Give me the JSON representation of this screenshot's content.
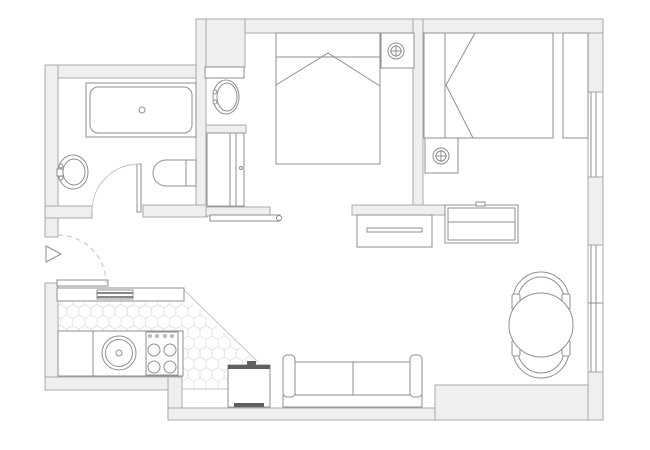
{
  "plan": {
    "canvas": {
      "w": 650,
      "h": 450,
      "bg": "#ffffff"
    },
    "palette": {
      "wallFill": "#efefef",
      "wallStroke": "#a9a9a9",
      "line": "#8f8f8f",
      "lightLine": "#c6c6c6",
      "dashLine": "#c2c2c2",
      "dark": "#606060",
      "hexLine": "#e6e6e6",
      "white": "#ffffff"
    },
    "elements": [
      {
        "name": "kitchen-hex-floor",
        "t": "polygon",
        "pts": "58,300 184,296 256,362 229,389 183,389 183,331 58,331",
        "f": "hex",
        "s": "none"
      },
      {
        "name": "top-wall",
        "t": "rect",
        "x": 197,
        "y": 19,
        "w": 406,
        "h": 14,
        "f": "wallFill",
        "s": "wallStroke"
      },
      {
        "name": "niche-top-wall-block",
        "t": "rect",
        "x": 196,
        "y": 19,
        "w": 49,
        "h": 48,
        "f": "wallFill",
        "s": "wallStroke"
      },
      {
        "name": "bathroom-top-wall",
        "t": "rect",
        "x": 45,
        "y": 65,
        "w": 152,
        "h": 13,
        "f": "wallFill",
        "s": "wallStroke"
      },
      {
        "name": "left-wall-upper",
        "t": "rect",
        "x": 45,
        "y": 65,
        "w": 13,
        "h": 172,
        "f": "wallFill",
        "s": "wallStroke"
      },
      {
        "name": "entry-wall-stub",
        "t": "rect",
        "x": 45,
        "y": 206,
        "w": 47,
        "h": 12,
        "f": "wallFill",
        "s": "wallStroke"
      },
      {
        "name": "left-wall-lower",
        "t": "rect",
        "x": 45,
        "y": 283,
        "w": 13,
        "h": 107,
        "f": "wallFill",
        "s": "wallStroke"
      },
      {
        "name": "bathroom-niche-wall",
        "t": "rect",
        "x": 196,
        "y": 19,
        "w": 10,
        "h": 198,
        "f": "wallFill",
        "s": "wallStroke"
      },
      {
        "name": "wc-bottom-wall",
        "t": "rect",
        "x": 143,
        "y": 205,
        "w": 64,
        "h": 12,
        "f": "wallFill",
        "s": "wallStroke"
      },
      {
        "name": "niche-bottom-bar",
        "t": "rect",
        "x": 206,
        "y": 207,
        "w": 64,
        "h": 9,
        "f": "wallFill",
        "s": "wallStroke"
      },
      {
        "name": "bedroom-divider-wall",
        "t": "rect",
        "x": 413,
        "y": 19,
        "w": 10,
        "h": 196,
        "f": "wallFill",
        "s": "wallStroke"
      },
      {
        "name": "bedroom-living-wall",
        "t": "rect",
        "x": 352,
        "y": 205,
        "w": 93,
        "h": 10,
        "f": "wallFill",
        "s": "wallStroke"
      },
      {
        "name": "kitchen-bottom-wall",
        "t": "rect",
        "x": 45,
        "y": 377,
        "w": 137,
        "h": 13,
        "f": "wallFill",
        "s": "wallStroke"
      },
      {
        "name": "bottom-jog-wall",
        "t": "rect",
        "x": 168,
        "y": 377,
        "w": 14,
        "h": 43,
        "f": "wallFill",
        "s": "wallStroke"
      },
      {
        "name": "bottom-wall-mid",
        "t": "rect",
        "x": 168,
        "y": 408,
        "w": 270,
        "h": 12,
        "f": "wallFill",
        "s": "wallStroke"
      },
      {
        "name": "bottom-wall-right",
        "t": "rect",
        "x": 435,
        "y": 385,
        "w": 168,
        "h": 35,
        "f": "wallFill",
        "s": "wallStroke"
      },
      {
        "name": "right-wall-upper",
        "t": "rect",
        "x": 588,
        "y": 33,
        "w": 15,
        "h": 59,
        "f": "wallFill",
        "s": "wallStroke"
      },
      {
        "name": "right-wall-mid",
        "t": "rect",
        "x": 588,
        "y": 177,
        "w": 15,
        "h": 68,
        "f": "wallFill",
        "s": "wallStroke"
      },
      {
        "name": "right-wall-lower",
        "t": "rect",
        "x": 588,
        "y": 372,
        "w": 15,
        "h": 48,
        "f": "wallFill",
        "s": "wallStroke"
      },
      {
        "name": "bedroom-window-opening",
        "t": "rect",
        "x": 588,
        "y": 92,
        "w": 15,
        "h": 85,
        "f": "white",
        "s": "wallStroke"
      },
      {
        "name": "bedroom-window-glass-a",
        "t": "line",
        "x1": 591,
        "y1": 92,
        "x2": 591,
        "y2": 177
      },
      {
        "name": "bedroom-window-glass-b",
        "t": "line",
        "x1": 596,
        "y1": 92,
        "x2": 596,
        "y2": 177
      },
      {
        "name": "living-window-opening",
        "t": "rect",
        "x": 588,
        "y": 245,
        "w": 15,
        "h": 127,
        "f": "white",
        "s": "wallStroke"
      },
      {
        "name": "living-window-glass-a",
        "t": "line",
        "x1": 591,
        "y1": 245,
        "x2": 591,
        "y2": 372
      },
      {
        "name": "living-window-glass-b",
        "t": "line",
        "x1": 596,
        "y1": 245,
        "x2": 596,
        "y2": 372
      },
      {
        "name": "living-window-mullion",
        "t": "line",
        "x1": 588,
        "y1": 303,
        "x2": 603,
        "y2": 303
      },
      {
        "name": "tile-edge-diagonal",
        "t": "line",
        "x1": 184,
        "y1": 290,
        "x2": 258,
        "y2": 362,
        "s": "lightLine"
      },
      {
        "name": "floor-step-line",
        "t": "line",
        "x1": 182,
        "y1": 389,
        "x2": 228,
        "y2": 389,
        "s": "lightLine"
      },
      {
        "name": "bathtub-outer",
        "t": "rect",
        "x": 86,
        "y": 83,
        "w": 110,
        "h": 54,
        "f": "white"
      },
      {
        "name": "bathtub-inner",
        "t": "rect",
        "x": 90,
        "y": 87,
        "w": 102,
        "h": 46,
        "rx": 8
      },
      {
        "name": "bathtub-drain",
        "t": "circle",
        "cx": 142,
        "cy": 110,
        "r": 3
      },
      {
        "name": "bathroom-sink",
        "t": "ellipse",
        "cx": 73,
        "cy": 172,
        "rx": 15,
        "ry": 17,
        "f": "white"
      },
      {
        "name": "bathroom-sink-basin",
        "t": "ellipse",
        "cx": 74,
        "cy": 172,
        "rx": 11,
        "ry": 13
      },
      {
        "name": "bathroom-sink-tap-a",
        "t": "circle",
        "cx": 61,
        "cy": 166,
        "r": 2,
        "f": "white"
      },
      {
        "name": "bathroom-sink-tap-b",
        "t": "circle",
        "cx": 61,
        "cy": 178,
        "r": 2,
        "f": "white"
      },
      {
        "name": "bathroom-sink-spout",
        "t": "rect",
        "x": 57,
        "y": 169,
        "w": 6,
        "h": 7,
        "f": "white"
      },
      {
        "name": "toilet",
        "t": "path",
        "d": "M196,160 L166,160 A13,13 0 0 0 166,186 L196,186 Z",
        "f": "white"
      },
      {
        "name": "toilet-tank-line",
        "t": "line",
        "x1": 186,
        "y1": 160,
        "x2": 186,
        "y2": 186
      },
      {
        "name": "vanity-top-bar",
        "t": "rect",
        "x": 205,
        "y": 67,
        "w": 39,
        "h": 11,
        "f": "white"
      },
      {
        "name": "niche-sink",
        "t": "ellipse",
        "cx": 226,
        "cy": 97,
        "rx": 13,
        "ry": 17,
        "f": "white"
      },
      {
        "name": "niche-sink-basin",
        "t": "ellipse",
        "cx": 227,
        "cy": 97,
        "rx": 10,
        "ry": 14
      },
      {
        "name": "niche-sink-tap-a",
        "t": "circle",
        "cx": 215,
        "cy": 92,
        "r": 2,
        "f": "white"
      },
      {
        "name": "niche-sink-tap-b",
        "t": "circle",
        "cx": 215,
        "cy": 102,
        "r": 2,
        "f": "white"
      },
      {
        "name": "niche-separator",
        "t": "rect",
        "x": 206,
        "y": 125,
        "w": 40,
        "h": 8,
        "f": "wallFill",
        "s": "wallStroke"
      },
      {
        "name": "niche-closet",
        "t": "rect",
        "x": 207,
        "y": 133,
        "w": 37,
        "h": 73,
        "f": "white"
      },
      {
        "name": "niche-closet-door-a",
        "t": "line",
        "x1": 230,
        "y1": 133,
        "x2": 230,
        "y2": 206
      },
      {
        "name": "niche-closet-door-b",
        "t": "line",
        "x1": 236,
        "y1": 133,
        "x2": 236,
        "y2": 206
      },
      {
        "name": "niche-closet-handle",
        "t": "circle",
        "cx": 241,
        "cy": 168,
        "r": 1.5
      },
      {
        "name": "bedroom-wall-shelf",
        "t": "rect",
        "x": 210,
        "y": 215,
        "w": 70,
        "h": 6,
        "f": "white"
      },
      {
        "name": "bedroom-shelf-knob",
        "t": "circle",
        "cx": 279,
        "cy": 218,
        "r": 2.5,
        "f": "white"
      },
      {
        "name": "bathroom-door-leaf",
        "t": "rect",
        "x": 137,
        "y": 164,
        "w": 4,
        "h": 48,
        "f": "white"
      },
      {
        "name": "bathroom-door-arc",
        "t": "path",
        "d": "M139,164 A47,47 0 0 0 92,211",
        "s": "lightLine"
      },
      {
        "name": "entry-door-leaf",
        "t": "rect",
        "x": 57,
        "y": 280,
        "w": 51,
        "h": 6,
        "f": "white"
      },
      {
        "name": "entry-door-arc",
        "t": "path",
        "d": "M58,235 A48,48 0 0 1 106,283",
        "s": "dashLine",
        "dash": "5,4"
      },
      {
        "name": "entry-arrow",
        "t": "polygon",
        "pts": "46,246 61,254 46,262",
        "f": "white"
      },
      {
        "name": "double-bed",
        "t": "rect",
        "x": 276,
        "y": 33,
        "w": 104,
        "h": 131,
        "f": "white"
      },
      {
        "name": "double-bed-blanket-line",
        "t": "line",
        "x1": 276,
        "y1": 57,
        "x2": 380,
        "y2": 57
      },
      {
        "name": "double-bed-fold",
        "t": "polyline",
        "pts": "276,85 328,53 380,86"
      },
      {
        "name": "nightstand-1",
        "t": "rect",
        "x": 381,
        "y": 33,
        "w": 33,
        "h": 35,
        "f": "white"
      },
      {
        "name": "lamp-1-outer",
        "t": "circle",
        "cx": 396,
        "cy": 51,
        "r": 8,
        "f": "white"
      },
      {
        "name": "lamp-1-inner",
        "t": "circle",
        "cx": 396,
        "cy": 51,
        "r": 5
      },
      {
        "name": "lamp-1-cross-v",
        "t": "line",
        "x1": 396,
        "y1": 45,
        "x2": 396,
        "y2": 57
      },
      {
        "name": "lamp-1-cross-h",
        "t": "line",
        "x1": 390,
        "y1": 51,
        "x2": 402,
        "y2": 51
      },
      {
        "name": "dresser-1",
        "t": "rect",
        "x": 357,
        "y": 215,
        "w": 75,
        "h": 32,
        "f": "white"
      },
      {
        "name": "dresser-1-handle",
        "t": "rect",
        "x": 367,
        "y": 228,
        "w": 55,
        "h": 4,
        "f": "white"
      },
      {
        "name": "single-bed",
        "t": "rect",
        "x": 424,
        "y": 33,
        "w": 129,
        "h": 105,
        "f": "white"
      },
      {
        "name": "single-bed-pillow-line",
        "t": "line",
        "x1": 445,
        "y1": 33,
        "x2": 445,
        "y2": 138
      },
      {
        "name": "single-bed-fold",
        "t": "polyline",
        "pts": "475,33 446,85 473,138"
      },
      {
        "name": "single-bed-headboard",
        "t": "rect",
        "x": 563,
        "y": 33,
        "w": 25,
        "h": 105,
        "f": "white"
      },
      {
        "name": "nightstand-2",
        "t": "rect",
        "x": 425,
        "y": 138,
        "w": 33,
        "h": 35,
        "f": "white"
      },
      {
        "name": "lamp-2-outer",
        "t": "circle",
        "cx": 441,
        "cy": 156,
        "r": 8,
        "f": "white"
      },
      {
        "name": "lamp-2-inner",
        "t": "circle",
        "cx": 441,
        "cy": 156,
        "r": 5
      },
      {
        "name": "lamp-2-cross-v",
        "t": "line",
        "x1": 441,
        "y1": 150,
        "x2": 441,
        "y2": 162
      },
      {
        "name": "lamp-2-cross-h",
        "t": "line",
        "x1": 435,
        "y1": 156,
        "x2": 447,
        "y2": 156
      },
      {
        "name": "dresser-2",
        "t": "rect",
        "x": 445,
        "y": 205,
        "w": 73,
        "h": 38,
        "f": "white"
      },
      {
        "name": "dresser-2-inner",
        "t": "rect",
        "x": 448,
        "y": 208,
        "w": 67,
        "h": 32
      },
      {
        "name": "dresser-2-line",
        "t": "line",
        "x1": 448,
        "y1": 222,
        "x2": 515,
        "y2": 222
      },
      {
        "name": "dresser-2-tab",
        "t": "rect",
        "x": 476,
        "y": 202,
        "w": 9,
        "h": 4,
        "f": "white"
      },
      {
        "name": "bar-counter",
        "t": "rect",
        "x": 57,
        "y": 288,
        "w": 127,
        "h": 13,
        "f": "white"
      },
      {
        "name": "bar-counter-inset",
        "t": "rect",
        "x": 97,
        "y": 290,
        "w": 36,
        "h": 9,
        "f": "white"
      },
      {
        "name": "bar-inset-stripe-a",
        "t": "line",
        "x1": 97,
        "y1": 293,
        "x2": 133,
        "y2": 293,
        "s": "dark",
        "sw": 1.5
      },
      {
        "name": "bar-inset-stripe-b",
        "t": "line",
        "x1": 97,
        "y1": 297,
        "x2": 133,
        "y2": 297,
        "s": "dark",
        "sw": 1.5
      },
      {
        "name": "kitchen-counter",
        "t": "rect",
        "x": 58,
        "y": 331,
        "w": 125,
        "h": 45,
        "f": "white"
      },
      {
        "name": "kitchen-counter-divider",
        "t": "line",
        "x1": 93,
        "y1": 331,
        "x2": 93,
        "y2": 376
      },
      {
        "name": "kitchen-sink-outer",
        "t": "circle",
        "cx": 119,
        "cy": 353,
        "r": 17,
        "f": "white"
      },
      {
        "name": "kitchen-sink-inner",
        "t": "circle",
        "cx": 119,
        "cy": 353,
        "r": 13.5
      },
      {
        "name": "kitchen-sink-drain",
        "t": "circle",
        "cx": 119,
        "cy": 353,
        "r": 3
      },
      {
        "name": "stove",
        "t": "rect",
        "x": 146,
        "y": 332,
        "w": 32,
        "h": 43,
        "f": "white"
      },
      {
        "name": "stove-burner-1",
        "t": "circle",
        "cx": 154,
        "cy": 350,
        "r": 6
      },
      {
        "name": "stove-burner-2",
        "t": "circle",
        "cx": 170,
        "cy": 350,
        "r": 6
      },
      {
        "name": "stove-burner-3",
        "t": "circle",
        "cx": 154,
        "cy": 367,
        "r": 6
      },
      {
        "name": "stove-burner-4",
        "t": "circle",
        "cx": 170,
        "cy": 367,
        "r": 6
      },
      {
        "name": "stove-knob-1",
        "t": "circle",
        "cx": 150,
        "cy": 336,
        "r": 1.3
      },
      {
        "name": "stove-knob-2",
        "t": "circle",
        "cx": 157,
        "cy": 336,
        "r": 1.3
      },
      {
        "name": "stove-knob-3",
        "t": "circle",
        "cx": 165,
        "cy": 336,
        "r": 1.3
      },
      {
        "name": "stove-knob-4",
        "t": "circle",
        "cx": 172,
        "cy": 336,
        "r": 1.3
      },
      {
        "name": "tv-unit",
        "t": "rect",
        "x": 228,
        "y": 365,
        "w": 42,
        "h": 42,
        "f": "white"
      },
      {
        "name": "tv-unit-top-bar",
        "t": "rect",
        "x": 228,
        "y": 365,
        "w": 42,
        "h": 4,
        "f": "dark",
        "s": "none"
      },
      {
        "name": "tv-unit-bottom-bar",
        "t": "rect",
        "x": 234,
        "y": 403,
        "w": 30,
        "h": 4,
        "f": "dark",
        "s": "none"
      },
      {
        "name": "tv-unit-nub",
        "t": "rect",
        "x": 247,
        "y": 361,
        "w": 9,
        "h": 4,
        "f": "dark",
        "s": "none"
      },
      {
        "name": "sofa-back",
        "t": "rect",
        "x": 283,
        "y": 395,
        "w": 139,
        "h": 12,
        "f": "white"
      },
      {
        "name": "sofa-seat-left",
        "t": "rect",
        "x": 295,
        "y": 362,
        "w": 58,
        "h": 33,
        "f": "white"
      },
      {
        "name": "sofa-seat-right",
        "t": "rect",
        "x": 353,
        "y": 362,
        "w": 57,
        "h": 33,
        "f": "white"
      },
      {
        "name": "sofa-arm-left",
        "t": "rect",
        "x": 283,
        "y": 355,
        "w": 12,
        "h": 42,
        "rx": 4,
        "f": "white"
      },
      {
        "name": "sofa-arm-right",
        "t": "rect",
        "x": 410,
        "y": 355,
        "w": 12,
        "h": 42,
        "rx": 4,
        "f": "white"
      },
      {
        "name": "chair-top-outer",
        "t": "path",
        "d": "M513,306 L513,300 A28,28 0 0 1 569,300 L569,306"
      },
      {
        "name": "chair-top-inner",
        "t": "path",
        "d": "M518,306 L518,300 A23,23 0 0 1 564,300 L564,306"
      },
      {
        "name": "chair-top-arm-left",
        "t": "rect",
        "x": 512,
        "y": 294,
        "w": 8,
        "h": 16,
        "rx": 2,
        "f": "white"
      },
      {
        "name": "chair-top-arm-right",
        "t": "rect",
        "x": 562,
        "y": 294,
        "w": 8,
        "h": 16,
        "rx": 2,
        "f": "white"
      },
      {
        "name": "chair-bottom-outer",
        "t": "path",
        "d": "M513,344 L513,350 A28,28 0 0 0 569,350 L569,344"
      },
      {
        "name": "chair-bottom-inner",
        "t": "path",
        "d": "M518,344 L518,350 A23,23 0 0 0 564,350 L564,344"
      },
      {
        "name": "chair-bottom-arm-left",
        "t": "rect",
        "x": 512,
        "y": 340,
        "w": 8,
        "h": 16,
        "rx": 2,
        "f": "white"
      },
      {
        "name": "chair-bottom-arm-right",
        "t": "rect",
        "x": 562,
        "y": 340,
        "w": 8,
        "h": 16,
        "rx": 2,
        "f": "white"
      },
      {
        "name": "dining-table",
        "t": "circle",
        "cx": 541,
        "cy": 325,
        "r": 32,
        "f": "white"
      }
    ]
  }
}
